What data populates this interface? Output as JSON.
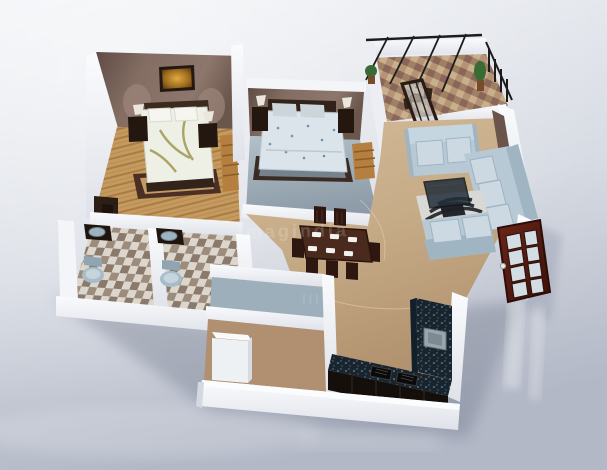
{
  "scene": {
    "type": "3d-isometric-floor-plan-render",
    "description": "Photorealistic 3D cutaway floor plan of a 2-bedroom apartment on a glossy grey studio backdrop",
    "watermark": {
      "text": "Imagindia",
      "text_partial": "ill"
    }
  },
  "palette": {
    "bg_top": "#eef0f4",
    "bg_bottom": "#b2b8c6",
    "wall_face": "#f4f5f8",
    "wall_top": "#fbfcfd",
    "wall_shade": "#d4d8e1",
    "accent_wall": "#7b655c",
    "accent_wall_dark": "#584640",
    "wood_floor": "#c59a5f",
    "wood_floor_dark": "#a87c44",
    "bedroom2_floor": "#a9b6c0",
    "tile_floor": "#c9ae8b",
    "balcony_tile": "#a98866",
    "checker_light": "#ddd6cd",
    "checker_dark": "#8a7a6c",
    "granite": "#18242e",
    "sofa": "#b7c9d4",
    "sofa_dark": "#a0b5c2",
    "door": "#5a2016",
    "door_pane": "#d3dde4",
    "dining_wood": "#4a2a1c",
    "dark_furniture": "#241710",
    "bench_wood": "#b5803f",
    "rug_border": "#4b2e24",
    "toilet": "#a7bcc8",
    "lamp_shade": "#ebe7dd",
    "plant_green": "#3a6b35",
    "railing_black": "#1c1c1c",
    "watermark_color": "#ffffff"
  },
  "rooms": [
    {
      "id": "master-bedroom",
      "label": "Master Bedroom",
      "floor": "wood planks",
      "furniture": [
        "double bed with leaf-print duvet",
        "two dark nightstands",
        "two table lamps",
        "gold wall art",
        "wood bench",
        "rug",
        "desk and chair"
      ]
    },
    {
      "id": "bedroom-2",
      "label": "Bedroom 2",
      "floor": "grey",
      "furniture": [
        "double bed with floral blue duvet",
        "two dark nightstands",
        "two table lamps",
        "wood bench",
        "dark rug"
      ]
    },
    {
      "id": "balcony",
      "label": "Balcony / Terrace",
      "floor": "brown mosaic tile",
      "furniture": [
        "black pergola beams",
        "black railing",
        "two potted plants",
        "bistro table and chairs",
        "dark framed glass door"
      ]
    },
    {
      "id": "living-room",
      "label": "Living Room",
      "floor": "beige tile",
      "furniture": [
        "loveseat",
        "three-seat sofa",
        "two-seat sofa",
        "glass coffee table",
        "black and white swirl rug",
        "mahogany glazed entry door"
      ]
    },
    {
      "id": "dining-area",
      "label": "Dining Area",
      "floor": "beige marble tile",
      "furniture": [
        "dark wood dining table",
        "six chairs",
        "white place settings"
      ]
    },
    {
      "id": "bathroom-1",
      "label": "Bathroom 1",
      "floor": "checker tile",
      "furniture": [
        "wash basin with dark counter",
        "toilet"
      ]
    },
    {
      "id": "bathroom-2",
      "label": "Bathroom 2",
      "floor": "checker tile",
      "furniture": [
        "wash basin with dark counter",
        "toilet"
      ]
    },
    {
      "id": "utility-room",
      "label": "Utility Room",
      "floor": "grey",
      "furniture": []
    },
    {
      "id": "store-room",
      "label": "Store Room",
      "floor": "brown tile",
      "furniture": [
        "white cabinet box"
      ]
    },
    {
      "id": "kitchen",
      "label": "Kitchen",
      "floor": "beige tile",
      "furniture": [
        "L-shaped dark granite counter",
        "stainless sink",
        "hob burners",
        "dark cabinets"
      ]
    }
  ]
}
